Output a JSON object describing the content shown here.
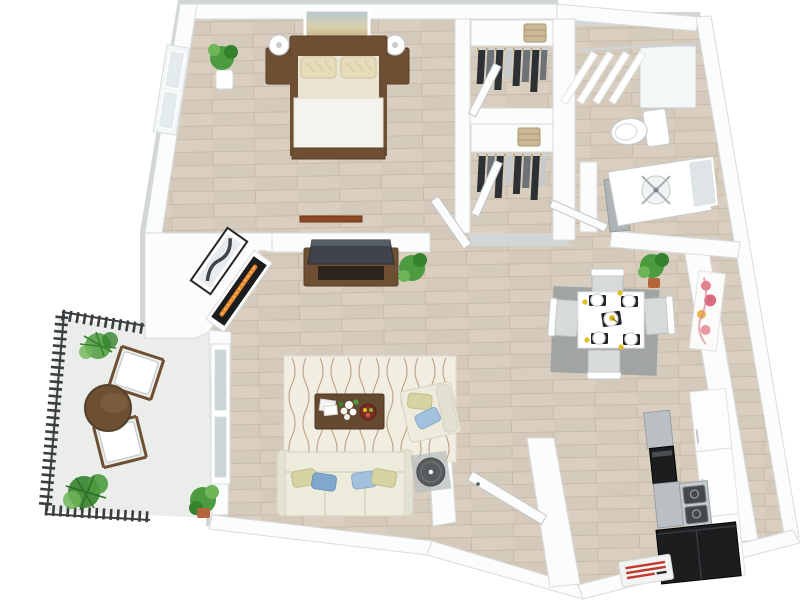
{
  "scene": {
    "type": "3d-floor-plan-render",
    "view": "top-down-perspective",
    "background": "white",
    "text_labels": []
  },
  "rooms": [
    {
      "id": "bedroom",
      "furniture": [
        {
          "name": "wall-art-beach",
          "count": 1
        },
        {
          "name": "table-lamp",
          "count": 2
        },
        {
          "name": "nightstand",
          "count": 2
        },
        {
          "name": "double-bed",
          "count": 1
        },
        {
          "name": "pillow",
          "count": 2
        },
        {
          "name": "duvet-ottoman",
          "count": 1
        },
        {
          "name": "potted-plant",
          "count": 1
        },
        {
          "name": "window",
          "count": 1
        },
        {
          "name": "wall-shelf",
          "count": 1
        },
        {
          "name": "door",
          "count": 1
        }
      ]
    },
    {
      "id": "closet-a",
      "furniture": [
        {
          "name": "shelf",
          "count": 1
        },
        {
          "name": "storage-basket",
          "count": 1
        },
        {
          "name": "hanging-clothes",
          "count": 8
        },
        {
          "name": "door",
          "count": 1
        }
      ]
    },
    {
      "id": "closet-b",
      "furniture": [
        {
          "name": "shelf",
          "count": 1
        },
        {
          "name": "storage-basket",
          "count": 1
        },
        {
          "name": "hanging-clothes",
          "count": 8
        },
        {
          "name": "door",
          "count": 1
        }
      ]
    },
    {
      "id": "bathroom",
      "furniture": [
        {
          "name": "shower",
          "count": 1
        },
        {
          "name": "shower-curtain",
          "count": 1
        },
        {
          "name": "shower-rod",
          "count": 1
        },
        {
          "name": "toilet",
          "count": 1
        },
        {
          "name": "vanity-sink",
          "count": 1
        },
        {
          "name": "mirror",
          "count": 1
        },
        {
          "name": "door",
          "count": 1
        }
      ]
    },
    {
      "id": "living-room",
      "furniture": [
        {
          "name": "fireplace",
          "count": 1
        },
        {
          "name": "mantel-art",
          "count": 1
        },
        {
          "name": "tv-console",
          "count": 1
        },
        {
          "name": "tv",
          "count": 1
        },
        {
          "name": "potted-plant",
          "count": 2
        },
        {
          "name": "area-rug",
          "count": 1
        },
        {
          "name": "coffee-table",
          "count": 1
        },
        {
          "name": "vase-flowers",
          "count": 1
        },
        {
          "name": "serving-bowl",
          "count": 1
        },
        {
          "name": "sofa",
          "count": 1
        },
        {
          "name": "throw-pillow",
          "count": 4
        },
        {
          "name": "armchair",
          "count": 1
        },
        {
          "name": "side-table",
          "count": 1
        }
      ]
    },
    {
      "id": "dining-area",
      "furniture": [
        {
          "name": "dining-table",
          "count": 1
        },
        {
          "name": "dining-chair",
          "count": 4
        },
        {
          "name": "placemat",
          "count": 5
        },
        {
          "name": "plate",
          "count": 5
        },
        {
          "name": "rug",
          "count": 1
        },
        {
          "name": "wall-art-abstract",
          "count": 1
        },
        {
          "name": "potted-plant",
          "count": 1
        }
      ]
    },
    {
      "id": "kitchen",
      "furniture": [
        {
          "name": "tall-cabinet",
          "count": 1
        },
        {
          "name": "upper-cabinet",
          "count": 2
        },
        {
          "name": "wall-oven",
          "count": 1
        },
        {
          "name": "cooktop-sink-unit",
          "count": 1
        },
        {
          "name": "base-cabinet",
          "count": 1
        },
        {
          "name": "doormat",
          "count": 1
        }
      ]
    },
    {
      "id": "entry",
      "furniture": [
        {
          "name": "front-door",
          "count": 1
        }
      ]
    },
    {
      "id": "balcony",
      "furniture": [
        {
          "name": "railing",
          "count": 3
        },
        {
          "name": "bistro-table",
          "count": 1
        },
        {
          "name": "patio-chair",
          "count": 2
        },
        {
          "name": "potted-palm",
          "count": 1
        },
        {
          "name": "potted-plant",
          "count": 1
        },
        {
          "name": "sliding-glass-door",
          "count": 1
        }
      ]
    }
  ],
  "colors": {
    "canvas_bg": "#ffffff",
    "slab": "#d3d6d7",
    "wall": "#fbfcfc",
    "wall_stroke": "#d9dcdd",
    "wood1": "#d9cec0",
    "wood2": "#cabdac",
    "wood_line": "#bfb19e",
    "balcony_floor": "#eaede9",
    "railing": "#3b3e41",
    "glass": "#ccd6d9",
    "furn_wood_dark": "#54402b",
    "furn_wood": "#6e4f33",
    "furn_wood_light": "#8a6a45",
    "bedding": "#eae4d2",
    "duvet": "#f4f3ee",
    "pillow_tan": "#e6dcba",
    "sofa": "#edebdc",
    "sofa_line": "#d6d3c0",
    "rug_cream": "#f2ede1",
    "rug_wave": "#b19677",
    "rug_gray": "#9aa0a0",
    "pillow_blue": "#a3c1dd",
    "pillow_blue2": "#7fa8cc",
    "pillow_sage": "#d8d3a2",
    "tv_dark": "#3e444a",
    "black": "#1b1d1f",
    "steel": "#c6cbce",
    "steel_dark": "#43484c",
    "flame": "#e8872e",
    "plant": "#4c9b3e",
    "plant_dark": "#35822c",
    "pot_terracotta": "#b4653a",
    "fixture_stroke": "#c7cbcc",
    "mat_red": "#c0392b",
    "art_sky": "#b5c8d3",
    "art_sand": "#c9ad82",
    "art_dark": "#3f4649",
    "abstract_pink": "#e2808d",
    "abstract_red": "#d5506b",
    "abstract_yellow": "#e9b64a",
    "lemon": "#e0c020",
    "basket": "#cbb895",
    "garment_dark": "#2e3134",
    "garment_gray": "#6d7276",
    "garment_light": "#c7cacc"
  }
}
